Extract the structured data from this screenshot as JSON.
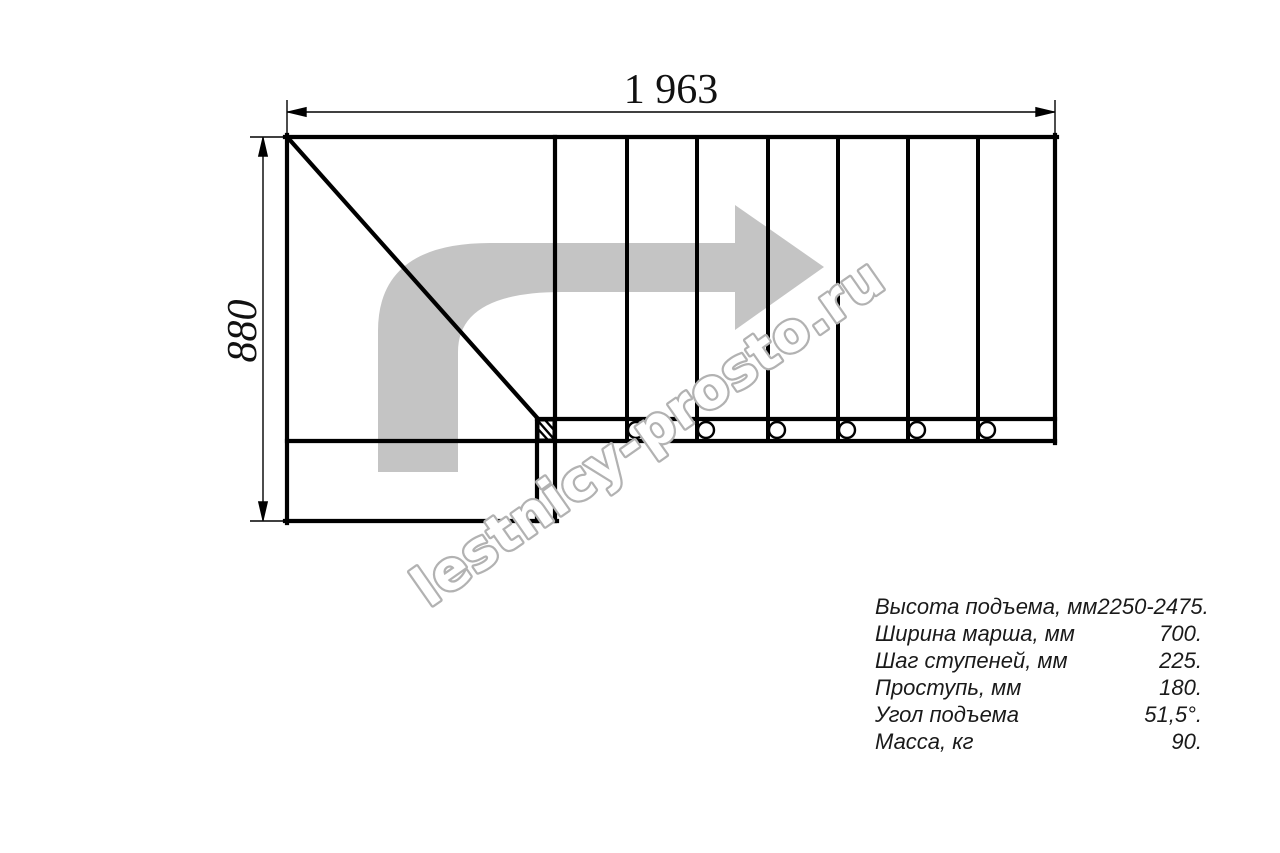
{
  "drawing": {
    "type": "staircase-plan-top-view",
    "dimensions": {
      "width_label": "1 963",
      "height_label": "880"
    },
    "watermark": {
      "text": "lestnicy-prosto.ru"
    }
  },
  "colors": {
    "line_black": "#000000",
    "arrow_gray": "#c4c4c4",
    "watermark_gray": "#b2b2b2"
  },
  "specs": {
    "rows": [
      {
        "label": "Высота подъема, мм",
        "value": "2250-2475."
      },
      {
        "label": "Ширина марша, мм",
        "value": "700."
      },
      {
        "label": "Шаг ступеней, мм",
        "value": "225."
      },
      {
        "label": "Проступь, мм",
        "value": "180."
      },
      {
        "label": "Угол подъема",
        "value": "51,5°."
      },
      {
        "label": "Масса, кг",
        "value": "90."
      }
    ]
  }
}
